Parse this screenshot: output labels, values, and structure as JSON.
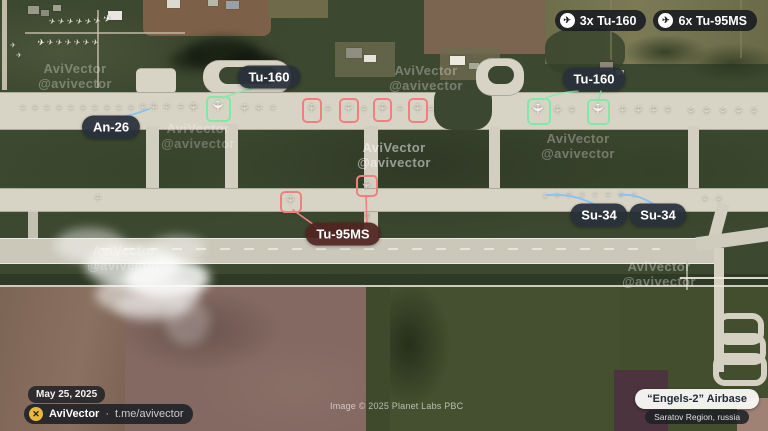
{
  "badges": [
    {
      "icon": "plane-icon",
      "label": "3x Tu-160"
    },
    {
      "icon": "plane-icon",
      "label": "6x Tu-95MS"
    }
  ],
  "footer": {
    "date": "May 25, 2025",
    "brand": "AviVector",
    "separator": "·",
    "handle": "t.me/avivector",
    "image_credit": "Image © 2025 Planet Labs PBC",
    "base_name": "“Engels-2” Airbase",
    "base_region": "Saratov Region, russia"
  },
  "colors": {
    "highlight_tu160": "#82e8a8",
    "highlight_tu95ms": "#f08080",
    "leader_blue": "#8cc3ee",
    "leader_green": "#8fe6ae",
    "leader_red": "#f08080",
    "label_dark_bg": "rgba(40,47,58,0.93)",
    "label_red_bg": "rgba(80,37,32,0.93)",
    "logo_gold": "#e9b83c"
  },
  "annotations": {
    "labels": [
      {
        "id": "tu160-left",
        "text": "Tu-160",
        "x": 269,
        "y": 77,
        "style": "dark"
      },
      {
        "id": "an26",
        "text": "An-26",
        "x": 111,
        "y": 127,
        "style": "dark"
      },
      {
        "id": "tu160-right",
        "text": "Tu-160",
        "x": 594,
        "y": 79,
        "style": "dark"
      },
      {
        "id": "tu95ms",
        "text": "Tu-95MS",
        "x": 343,
        "y": 234,
        "style": "red"
      },
      {
        "id": "su34-left",
        "text": "Su-34",
        "x": 599,
        "y": 215,
        "style": "dark"
      },
      {
        "id": "su34-right",
        "text": "Su-34",
        "x": 658,
        "y": 215,
        "style": "dark"
      }
    ],
    "highlight_boxes": [
      {
        "aircraft": "Tu-160",
        "color": "#82e8a8",
        "x": 206,
        "y": 96,
        "w": 21,
        "h": 22
      },
      {
        "aircraft": "Tu-160",
        "color": "#82e8a8",
        "x": 527,
        "y": 98,
        "w": 20,
        "h": 23
      },
      {
        "aircraft": "Tu-160",
        "color": "#82e8a8",
        "x": 587,
        "y": 99,
        "w": 19,
        "h": 22
      },
      {
        "aircraft": "Tu-95MS",
        "color": "#f08080",
        "x": 302,
        "y": 98,
        "w": 16,
        "h": 21
      },
      {
        "aircraft": "Tu-95MS",
        "color": "#f08080",
        "x": 339,
        "y": 98,
        "w": 16,
        "h": 21
      },
      {
        "aircraft": "Tu-95MS",
        "color": "#f08080",
        "x": 373,
        "y": 98,
        "w": 15,
        "h": 20
      },
      {
        "aircraft": "Tu-95MS",
        "color": "#f08080",
        "x": 408,
        "y": 98,
        "w": 16,
        "h": 21
      },
      {
        "aircraft": "Tu-95MS",
        "color": "#f08080",
        "x": 280,
        "y": 191,
        "w": 18,
        "h": 18
      },
      {
        "aircraft": "Tu-95MS",
        "color": "#f08080",
        "x": 356,
        "y": 175,
        "w": 18,
        "h": 18
      }
    ],
    "leader_lines": [
      {
        "color": "#8fe6ae",
        "width": 1.6,
        "path": "M252,89 Q236,92 223,98"
      },
      {
        "color": "#8cc3ee",
        "width": 2,
        "path": "M116,119 Q133,115 149,109"
      },
      {
        "color": "#8fe6ae",
        "width": 1.6,
        "path": "M578,91 Q554,93 543,100"
      },
      {
        "color": "#8fe6ae",
        "width": 1.6,
        "path": "M601,91 Q600,95 598,101"
      },
      {
        "color": "#f08080",
        "width": 1.6,
        "path": "M317,227 L293,210"
      },
      {
        "color": "#f08080",
        "width": 1.6,
        "path": "M367,224 L366,196"
      },
      {
        "color": "#8cc3ee",
        "width": 2,
        "path": "M597,206 C580,196 562,194 547,195"
      },
      {
        "color": "#8cc3ee",
        "width": 2,
        "path": "M656,206 C642,196 630,194 620,195"
      }
    ],
    "watermark": {
      "line1": "AviVector",
      "line2": "@avivector",
      "instances": [
        {
          "x": 75,
          "y": 61,
          "opacity": 0.3
        },
        {
          "x": 426,
          "y": 63,
          "opacity": 0.3
        },
        {
          "x": 198,
          "y": 121,
          "opacity": 0.26
        },
        {
          "x": 394,
          "y": 140,
          "opacity": 0.5
        },
        {
          "x": 578,
          "y": 131,
          "opacity": 0.3
        },
        {
          "x": 124,
          "y": 243,
          "opacity": 0.28
        },
        {
          "x": 659,
          "y": 259,
          "opacity": 0.34
        }
      ]
    },
    "aircraft_format": [
      "x",
      "y",
      "size",
      "rotation_deg",
      "tone"
    ],
    "aircraft_tones": {
      "b": "#f6f6ef",
      "l": "#dcd9cc",
      "t": "#cdbd9e"
    },
    "aircraft": [
      [
        52,
        22,
        8,
        15,
        "l"
      ],
      [
        61,
        22,
        8,
        15,
        "l"
      ],
      [
        70,
        22,
        8,
        15,
        "l"
      ],
      [
        79,
        22,
        8,
        15,
        "l"
      ],
      [
        88,
        22,
        8,
        15,
        "l"
      ],
      [
        97,
        21,
        9,
        15,
        "l"
      ],
      [
        107,
        20,
        10,
        15,
        "b"
      ],
      [
        41,
        43,
        9,
        10,
        "b"
      ],
      [
        50,
        43,
        8,
        10,
        "l"
      ],
      [
        59,
        43,
        8,
        10,
        "l"
      ],
      [
        68,
        43,
        8,
        10,
        "l"
      ],
      [
        77,
        43,
        8,
        10,
        "l"
      ],
      [
        86,
        43,
        8,
        10,
        "l"
      ],
      [
        95,
        43,
        8,
        10,
        "l"
      ],
      [
        13,
        46,
        7,
        0,
        "l"
      ],
      [
        19,
        56,
        7,
        0,
        "l"
      ],
      [
        22,
        108,
        8,
        90,
        "l"
      ],
      [
        34,
        108,
        8,
        90,
        "l"
      ],
      [
        46,
        108,
        8,
        90,
        "l"
      ],
      [
        58,
        108,
        8,
        90,
        "l"
      ],
      [
        70,
        108,
        8,
        90,
        "l"
      ],
      [
        82,
        108,
        8,
        90,
        "l"
      ],
      [
        94,
        108,
        8,
        90,
        "l"
      ],
      [
        106,
        108,
        8,
        90,
        "l"
      ],
      [
        118,
        108,
        8,
        90,
        "l"
      ],
      [
        130,
        108,
        8,
        90,
        "l"
      ],
      [
        142,
        107,
        9,
        90,
        "l"
      ],
      [
        152,
        107,
        10,
        90,
        "l"
      ],
      [
        166,
        107,
        9,
        90,
        "l"
      ],
      [
        180,
        107,
        8,
        90,
        "l"
      ],
      [
        193,
        107,
        12,
        90,
        "l"
      ],
      [
        217,
        106,
        15,
        90,
        "b"
      ],
      [
        243,
        108,
        11,
        90,
        "l"
      ],
      [
        258,
        108,
        9,
        90,
        "l"
      ],
      [
        272,
        108,
        8,
        90,
        "l"
      ],
      [
        310,
        108,
        11,
        90,
        "l"
      ],
      [
        327,
        109,
        8,
        90,
        "l"
      ],
      [
        347,
        108,
        11,
        90,
        "l"
      ],
      [
        363,
        109,
        8,
        90,
        "l"
      ],
      [
        381,
        108,
        11,
        90,
        "l"
      ],
      [
        399,
        109,
        8,
        90,
        "l"
      ],
      [
        416,
        108,
        11,
        90,
        "l"
      ],
      [
        430,
        109,
        8,
        90,
        "l"
      ],
      [
        537,
        109,
        15,
        90,
        "b"
      ],
      [
        556,
        110,
        11,
        90,
        "l"
      ],
      [
        571,
        110,
        9,
        90,
        "l"
      ],
      [
        597,
        109,
        15,
        90,
        "b"
      ],
      [
        621,
        110,
        10,
        90,
        "l"
      ],
      [
        637,
        110,
        11,
        90,
        "l"
      ],
      [
        652,
        110,
        10,
        90,
        "l"
      ],
      [
        667,
        110,
        9,
        90,
        "l"
      ],
      [
        690,
        111,
        9,
        90,
        "l"
      ],
      [
        705,
        111,
        10,
        90,
        "l"
      ],
      [
        722,
        111,
        9,
        90,
        "l"
      ],
      [
        737,
        111,
        10,
        90,
        "l"
      ],
      [
        753,
        111,
        9,
        90,
        "l"
      ],
      [
        97,
        198,
        9,
        90,
        "l"
      ],
      [
        289,
        200,
        11,
        90,
        "l"
      ],
      [
        365,
        185,
        11,
        90,
        "l"
      ],
      [
        368,
        217,
        10,
        -40,
        "t"
      ],
      [
        544,
        196,
        7,
        90,
        "l"
      ],
      [
        556,
        195,
        7,
        90,
        "l"
      ],
      [
        568,
        195,
        8,
        90,
        "l"
      ],
      [
        581,
        195,
        7,
        90,
        "l"
      ],
      [
        594,
        195,
        7,
        90,
        "l"
      ],
      [
        607,
        195,
        7,
        90,
        "l"
      ],
      [
        620,
        195,
        8,
        90,
        "l"
      ],
      [
        633,
        195,
        7,
        90,
        "l"
      ],
      [
        704,
        199,
        8,
        90,
        "l"
      ],
      [
        718,
        199,
        8,
        90,
        "l"
      ]
    ]
  }
}
